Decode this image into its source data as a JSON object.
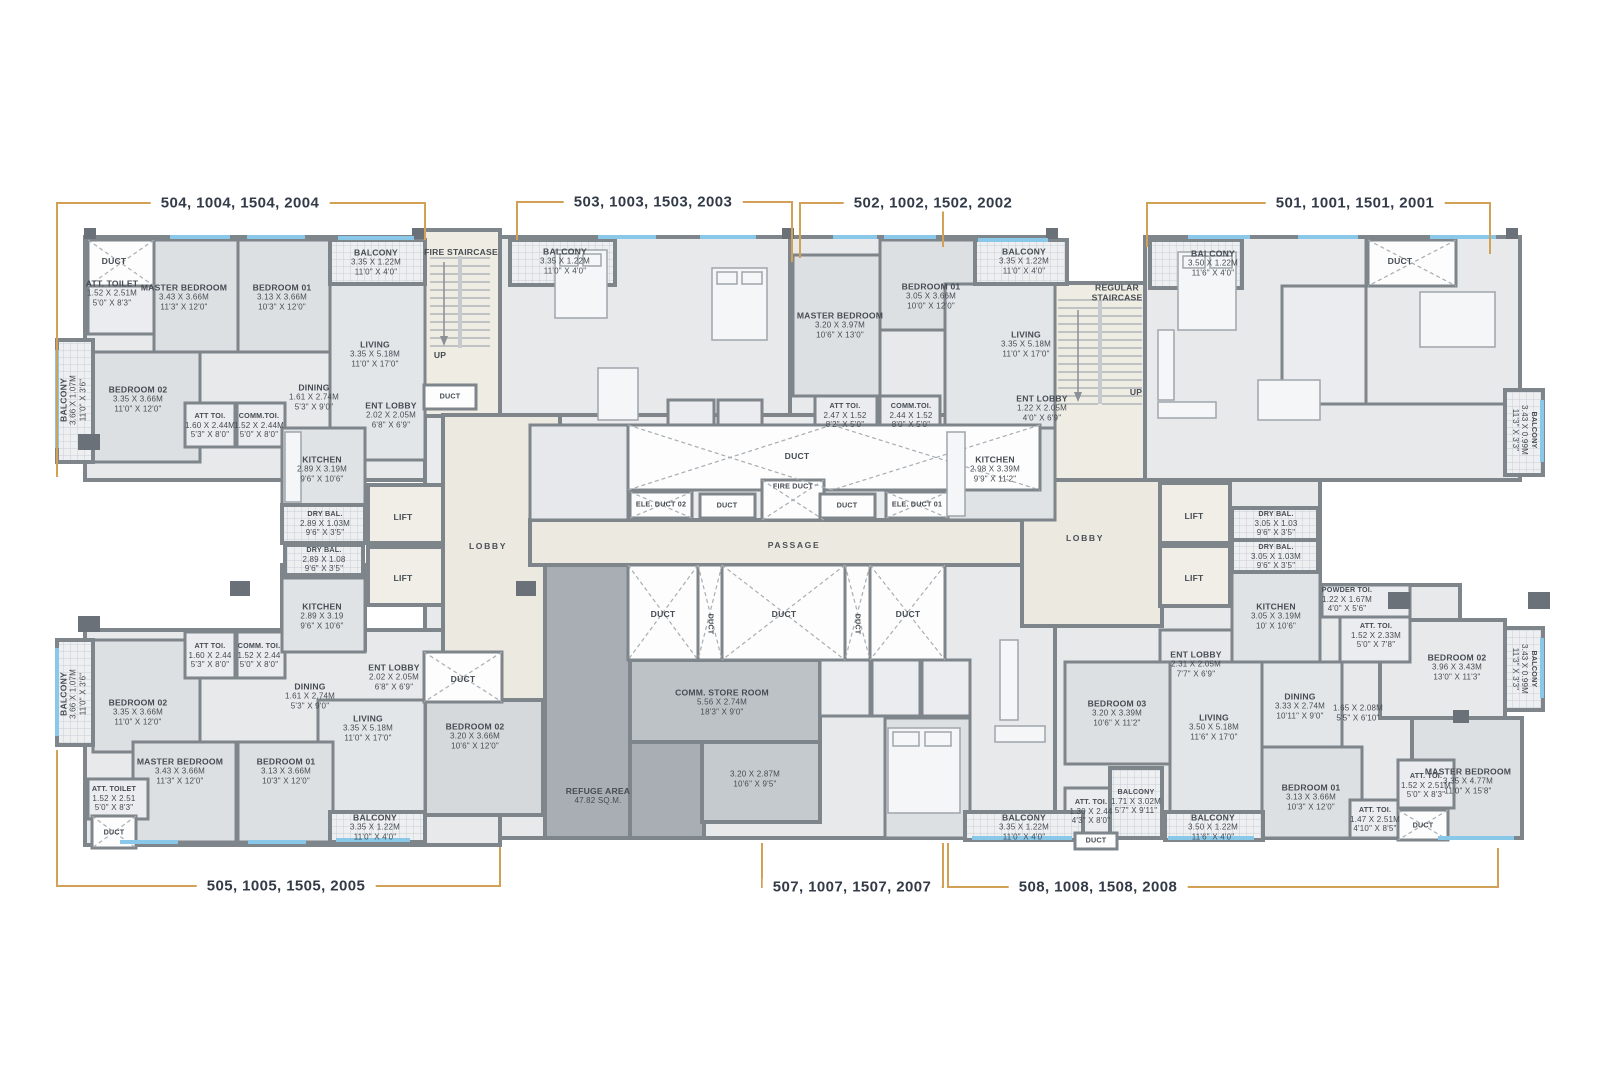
{
  "plan": {
    "units": {
      "u504": "504, 1004, 1504, 2004",
      "u503": "503, 1003, 1503, 2003",
      "u502": "502, 1002, 1502, 2002",
      "u501": "501, 1001, 1501, 2001",
      "u505": "505, 1005, 1505, 2005",
      "u507": "507, 1007, 1507, 2007",
      "u508": "508, 1008, 1508, 2008"
    },
    "core": {
      "lift": "LIFT",
      "lobby": "LOBBY",
      "passage": "PASSAGE",
      "up": "UP",
      "duct": "DUCT",
      "fire_duct": "FIRE DUCT",
      "ele_duct_02": "ELE. DUCT 02",
      "ele_duct_01": "ELE. DUCT 01",
      "fire_staircase": "FIRE STAIRCASE",
      "regular_staircase": "REGULAR STAIRCASE"
    },
    "rooms": {
      "b504_att_toilet": {
        "name": "ATT. TOILET",
        "m": "1.52 X 2.51M",
        "ft": "5'0\" X 8'3\""
      },
      "b504_master": {
        "name": "MASTER BEDROOM",
        "m": "3.43 X 3.66M",
        "ft": "11'3\" X 12'0\""
      },
      "b504_bed01": {
        "name": "BEDROOM 01",
        "m": "3.13 X 3.66M",
        "ft": "10'3\" X 12'0\""
      },
      "b504_balc_top": {
        "name": "BALCONY",
        "m": "3.35 X 1.22M",
        "ft": "11'0\" X 4'0\""
      },
      "b504_balc_left": {
        "name": "BALCONY",
        "m": "3.66 X 1.07M",
        "ft": "11'0\" X 3'6\""
      },
      "b504_bed02": {
        "name": "BEDROOM 02",
        "m": "3.35 X 3.66M",
        "ft": "11'0\" X 12'0\""
      },
      "b504_living": {
        "name": "LIVING",
        "m": "3.35 X 5.18M",
        "ft": "11'0\" X 17'0\""
      },
      "b504_dining": {
        "name": "DINING",
        "m": "1.61 X 2.74M",
        "ft": "5'3\" X 9'0\""
      },
      "b504_ent_lobby": {
        "name": "ENT LOBBY",
        "m": "2.02 X 2.05M",
        "ft": "6'8\" X 6'9\""
      },
      "b504_att_toi": {
        "name": "ATT TOI.",
        "m": "1.60 X 2.44M",
        "ft": "5'3\" X 8'0\""
      },
      "b504_comm_toi": {
        "name": "COMM.TOI.",
        "m": "1.52 X 2.44M",
        "ft": "5'0\" X 8'0\""
      },
      "b504_kitchen": {
        "name": "KITCHEN",
        "m": "2.89 X 3.19M",
        "ft": "9'6\" X 10'6\""
      },
      "b504_dry_bal": {
        "name": "DRY BAL.",
        "m": "2.89 X 1.03M",
        "ft": "9'6\" X 3'5\""
      },
      "b505_dry_bal": {
        "name": "DRY BAL.",
        "m": "2.89 X 1.08",
        "ft": "9'6\" X 3'5\""
      },
      "b503_balc_top": {
        "name": "BALCONY",
        "m": "3.35 X 1.22M",
        "ft": "11'0\" X 4'0\""
      },
      "b502_master": {
        "name": "MASTER BEDROOM",
        "m": "3.20 X 3.97M",
        "ft": "10'6\" X 13'0\""
      },
      "b502_bed01": {
        "name": "BEDROOM 01",
        "m": "3.05 X 3.66M",
        "ft": "10'0\" X 12'0\""
      },
      "b502_balc_top": {
        "name": "BALCONY",
        "m": "3.35 X 1.22M",
        "ft": "11'0\" X 4'0\""
      },
      "b502_living": {
        "name": "LIVING",
        "m": "3.35 X 5.18M",
        "ft": "11'0\" X 17'0\""
      },
      "b502_ent_lobby": {
        "name": "ENT LOBBY",
        "m": "1.22 X 2.05M",
        "ft": "4'0\" X 6'9\""
      },
      "b502_att_toi": {
        "name": "ATT TOI.",
        "m": "2.47 X 1.52",
        "ft": "8'2\" X 5'0\""
      },
      "b502_comm_toi": {
        "name": "COMM.TOI.",
        "m": "2.44 X 1.52",
        "ft": "8'0\" X 5'0\""
      },
      "b502_kitchen": {
        "name": "KITCHEN",
        "m": "2.98 X 3.39M",
        "ft": "9'9\" X 11'2\""
      },
      "b501_balc_top": {
        "name": "BALCONY",
        "m": "3.50 X 1.22M",
        "ft": "11'6\" X 4'0\""
      },
      "b501_balc_right": {
        "name": "BALCONY",
        "m": "3.43 X 0.99M",
        "ft": "11'3\" X 3'3\""
      },
      "b508_dry_bal1": {
        "name": "DRY BAL.",
        "m": "3.05 X 1.03",
        "ft": "9'6\" X 3'5\""
      },
      "b508_dry_bal2": {
        "name": "DRY BAL.",
        "m": "3.05 X 1.03M",
        "ft": "9'6\" X 3'5\""
      },
      "b508_powder": {
        "name": "POWDER TOI.",
        "m": "1.22 X 1.67M",
        "ft": "4'0\" X 5'6\""
      },
      "b508_kitchen": {
        "name": "KITCHEN",
        "m": "3.05 X 3.19M",
        "ft": "10' X 10'6\""
      },
      "b508_att_toi1": {
        "name": "ATT. TOI.",
        "m": "1.52 X 2.33M",
        "ft": "5'0\" X 7'8\""
      },
      "b508_ent_lobby": {
        "name": "ENT LOBBY",
        "m": "2.31 X 2.05M",
        "ft": "7'7\" X 6'9\""
      },
      "b508_bed03": {
        "name": "BEDROOM 03",
        "m": "3.20 X 3.39M",
        "ft": "10'6\" X 11'2\""
      },
      "b508_living": {
        "name": "LIVING",
        "m": "3.50 X 5.18M",
        "ft": "11'6\" X 17'0\""
      },
      "b508_dining": {
        "name": "DINING",
        "m": "3.33 X 2.74M",
        "ft": "10'11\" X 9'0\""
      },
      "b508_hall": {
        "m": "1.65 X 2.08M",
        "ft": "5'5\" X 6'10\""
      },
      "b508_bed02": {
        "name": "BEDROOM 02",
        "m": "3.96 X 3.43M",
        "ft": "13'0\" X 11'3\""
      },
      "b508_balc_right": {
        "name": "BALCONY",
        "m": "3.43 X 0.99M",
        "ft": "11'3\" X 3'3\""
      },
      "b508_master": {
        "name": "MASTER BEDROOM",
        "m": "3.35 X 4.77M",
        "ft": "11'0\" X 15'8\""
      },
      "b508_bed01": {
        "name": "BEDROOM 01",
        "m": "3.13 X 3.66M",
        "ft": "10'3\" X 12'0\""
      },
      "b508_att_toi2": {
        "name": "ATT. TOI.",
        "m": "1.52 X 2.51M",
        "ft": "5'0\" X 8'3\""
      },
      "b508_att_toi3": {
        "name": "ATT. TOI.",
        "m": "1.47 X 2.51M",
        "ft": "4'10\" X 8'5\""
      },
      "b508_att_toi4": {
        "name": "ATT. TOI.",
        "m": "1.30 X 2.44",
        "ft": "4'3\" X 8'0\""
      },
      "b508_balc_small": {
        "name": "BALCONY",
        "m": "1.71 X 3.02M",
        "ft": "5'7\" X 9'11\""
      },
      "b508_balc_bottom": {
        "name": "BALCONY",
        "m": "3.50 X 1.22M",
        "ft": "11'6\" X 4'0\""
      },
      "b505_balc_left": {
        "name": "BALCONY",
        "m": "3.66 X 1.07M",
        "ft": "11'0\" X 3'6\""
      },
      "b505_bed02": {
        "name": "BEDROOM 02",
        "m": "3.35 X 3.66M",
        "ft": "11'0\" X 12'0\""
      },
      "b505_att_toi": {
        "name": "ATT TOI.",
        "m": "1.60 X 2.44",
        "ft": "5'3\" X 8'0\""
      },
      "b505_comm_toi": {
        "name": "COMM. TOI.",
        "m": "1.52 X 2.44",
        "ft": "5'0\" X 8'0\""
      },
      "b505_dining": {
        "name": "DINING",
        "m": "1.61 X 2.74M",
        "ft": "5'3\" X 9'0\""
      },
      "b505_kitchen": {
        "name": "KITCHEN",
        "m": "2.89 X 3.19",
        "ft": "9'6\" X 10'6\""
      },
      "b505_ent_lobby": {
        "name": "ENT LOBBY",
        "m": "2.02 X 2.05M",
        "ft": "6'8\" X 6'9\""
      },
      "b505_living": {
        "name": "LIVING",
        "m": "3.35 X 5.18M",
        "ft": "11'0\" X 17'0\""
      },
      "b505_master": {
        "name": "MASTER BEDROOM",
        "m": "3.43 X 3.66M",
        "ft": "11'3\" X 12'0\""
      },
      "b505_bed01": {
        "name": "BEDROOM 01",
        "m": "3.13 X 3.66M",
        "ft": "10'3\" X 12'0\""
      },
      "b505_att_toilet": {
        "name": "ATT. TOILET",
        "m": "1.52 X 2.51",
        "ft": "5'0\" X 8'3\""
      },
      "b505_balc_bottom": {
        "name": "BALCONY",
        "m": "3.35 X 1.22M",
        "ft": "11'0\" X 4'0\""
      },
      "b507_bed02": {
        "name": "BEDROOM 02",
        "m": "3.20 X 3.66M",
        "ft": "10'6\" X 12'0\""
      },
      "b507_refuge": {
        "name": "REFUGE AREA",
        "m": "47.82 SQ.M."
      },
      "b507_store": {
        "name": "COMM. STORE ROOM",
        "m": "5.56 X 2.74M",
        "ft": "18'3\" X 9'0\""
      },
      "b507_room": {
        "m": "3.20 X 2.87M",
        "ft": "10'6\" X 9'5\""
      },
      "b507_balc_bottom": {
        "name": "BALCONY",
        "m": "3.35 X 1.22M",
        "ft": "11'0\" X 4'0\""
      }
    },
    "colors": {
      "wall": "#7E858B",
      "room": "#E7E9EB",
      "core_beige": "#EFECE3",
      "refuge_gray": "#A8AEB3",
      "window_blue": "#8AC8E9",
      "bracket_gold": "#D2A156",
      "label_text": "#454C53"
    }
  }
}
